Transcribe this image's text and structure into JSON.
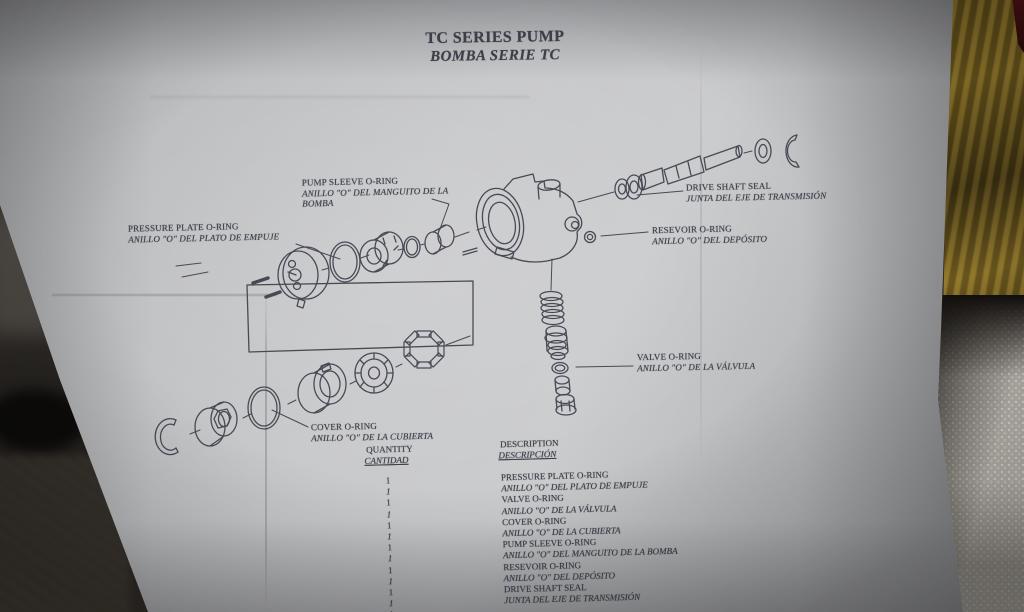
{
  "title": {
    "en": "TC SERIES PUMP",
    "es": "BOMBA SERIE TC"
  },
  "callouts": [
    {
      "en": "PUMP SLEEVE O-RING",
      "es": "ANILLO \"O\" DEL MANGUITO DE LA BOMBA"
    },
    {
      "en": "PRESSURE PLATE O-RING",
      "es": "ANILLO \"O\" DEL PLATO DE EMPUJE"
    },
    {
      "en": "DRIVE SHAFT SEAL",
      "es": "JUNTA DEL EJE DE TRANSMISIÓN"
    },
    {
      "en": "RESEVOIR O-RING",
      "es": "ANILLO \"O\" DEL DEPÓSITO"
    },
    {
      "en": "VALVE O-RING",
      "es": "ANILLO \"O\" DE LA VÁLVULA"
    },
    {
      "en": "COVER O-RING",
      "es": "ANILLO \"O\" DE LA CUBIERTA"
    }
  ],
  "table": {
    "headers": {
      "qty_en": "QUANTITY",
      "qty_es": "CANTIDAD",
      "desc_en": "DESCRIPTION",
      "desc_es": "DESCRIPCIÓN"
    },
    "rows": [
      {
        "qty": "1",
        "desc_en": "PRESSURE PLATE O-RING",
        "desc_es": "ANILLO \"O\" DEL PLATO DE EMPUJE"
      },
      {
        "qty": "1",
        "desc_en": "VALVE O-RING",
        "desc_es": "ANILLO \"O\" DE LA VÁLVULA"
      },
      {
        "qty": "1",
        "desc_en": "COVER O-RING",
        "desc_es": "ANILLO \"O\" DE LA CUBIERTA"
      },
      {
        "qty": "1",
        "desc_en": "PUMP SLEEVE O-RING",
        "desc_es": "ANILLO \"O\" DEL MANGUITO DE LA BOMBA"
      },
      {
        "qty": "1",
        "desc_en": "RESEVOIR O-RING",
        "desc_es": "ANILLO \"O\" DEL DEPÓSITO"
      },
      {
        "qty": "1",
        "desc_en": "DRIVE SHAFT SEAL",
        "desc_es": "JUNTA DEL EJE DE TRANSMISIÓN"
      }
    ],
    "partial_row_qty": "1"
  },
  "colors": {
    "ink": "#3d3e48",
    "paper": "#c0c1c4",
    "wood": "#8d7326",
    "towel": "#c7c2b9"
  }
}
